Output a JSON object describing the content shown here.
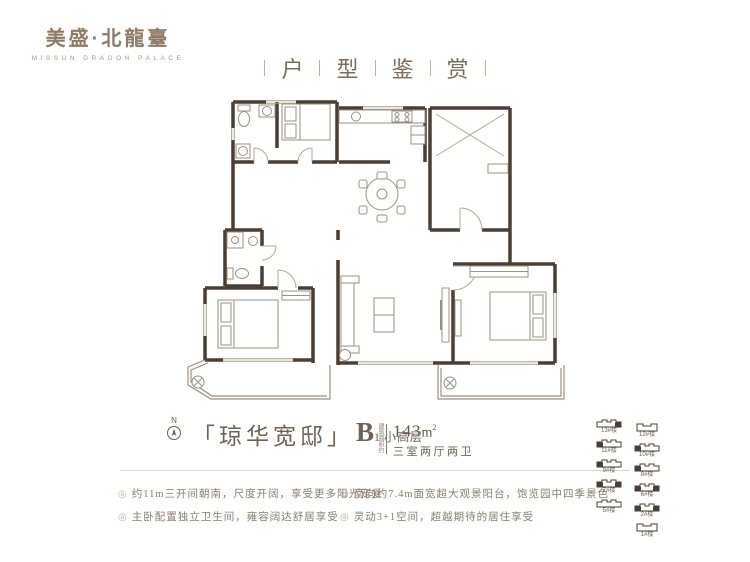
{
  "brand": {
    "name": "美盛·北龍臺",
    "sub": "MISSUN DRAGON PALACE"
  },
  "header": {
    "chars": [
      "户",
      "型",
      "鉴",
      "赏"
    ]
  },
  "unit": {
    "name": "「琼华宽邸」",
    "type_letter": "B",
    "type_sub": "1",
    "type_note": "小高层",
    "area_label": "建筑面积约",
    "area_number": "143",
    "area_unit": "m",
    "area_sup": "2",
    "layout": "三室两厅两卫"
  },
  "compass": {
    "label": "N"
  },
  "features": {
    "bullet": "◎",
    "items_left": [
      "约11m三开间朝南，尺度开阔，享受更多阳光宠爱",
      "主卧配置独立卫生间，雍容阔达舒居享受"
    ],
    "items_right": [
      "南向约7.4m面宽超大观景阳台，饱览园中四季景色",
      "灵动3+1空间，超越期待的居住享受"
    ]
  },
  "keyplan": {
    "left": [
      "13#楼",
      "11#楼",
      "9#楼",
      "7#楼",
      "5#楼"
    ],
    "right": [
      "12#楼",
      "10#楼",
      "8#楼",
      "6#楼",
      "2#楼",
      "1#楼"
    ]
  },
  "colors": {
    "brand": "#8d7a66",
    "walls": "#4a3d33",
    "light_lines": "#a89c8e",
    "text": "#8a7c6b",
    "divider": "#d9d4cc"
  }
}
